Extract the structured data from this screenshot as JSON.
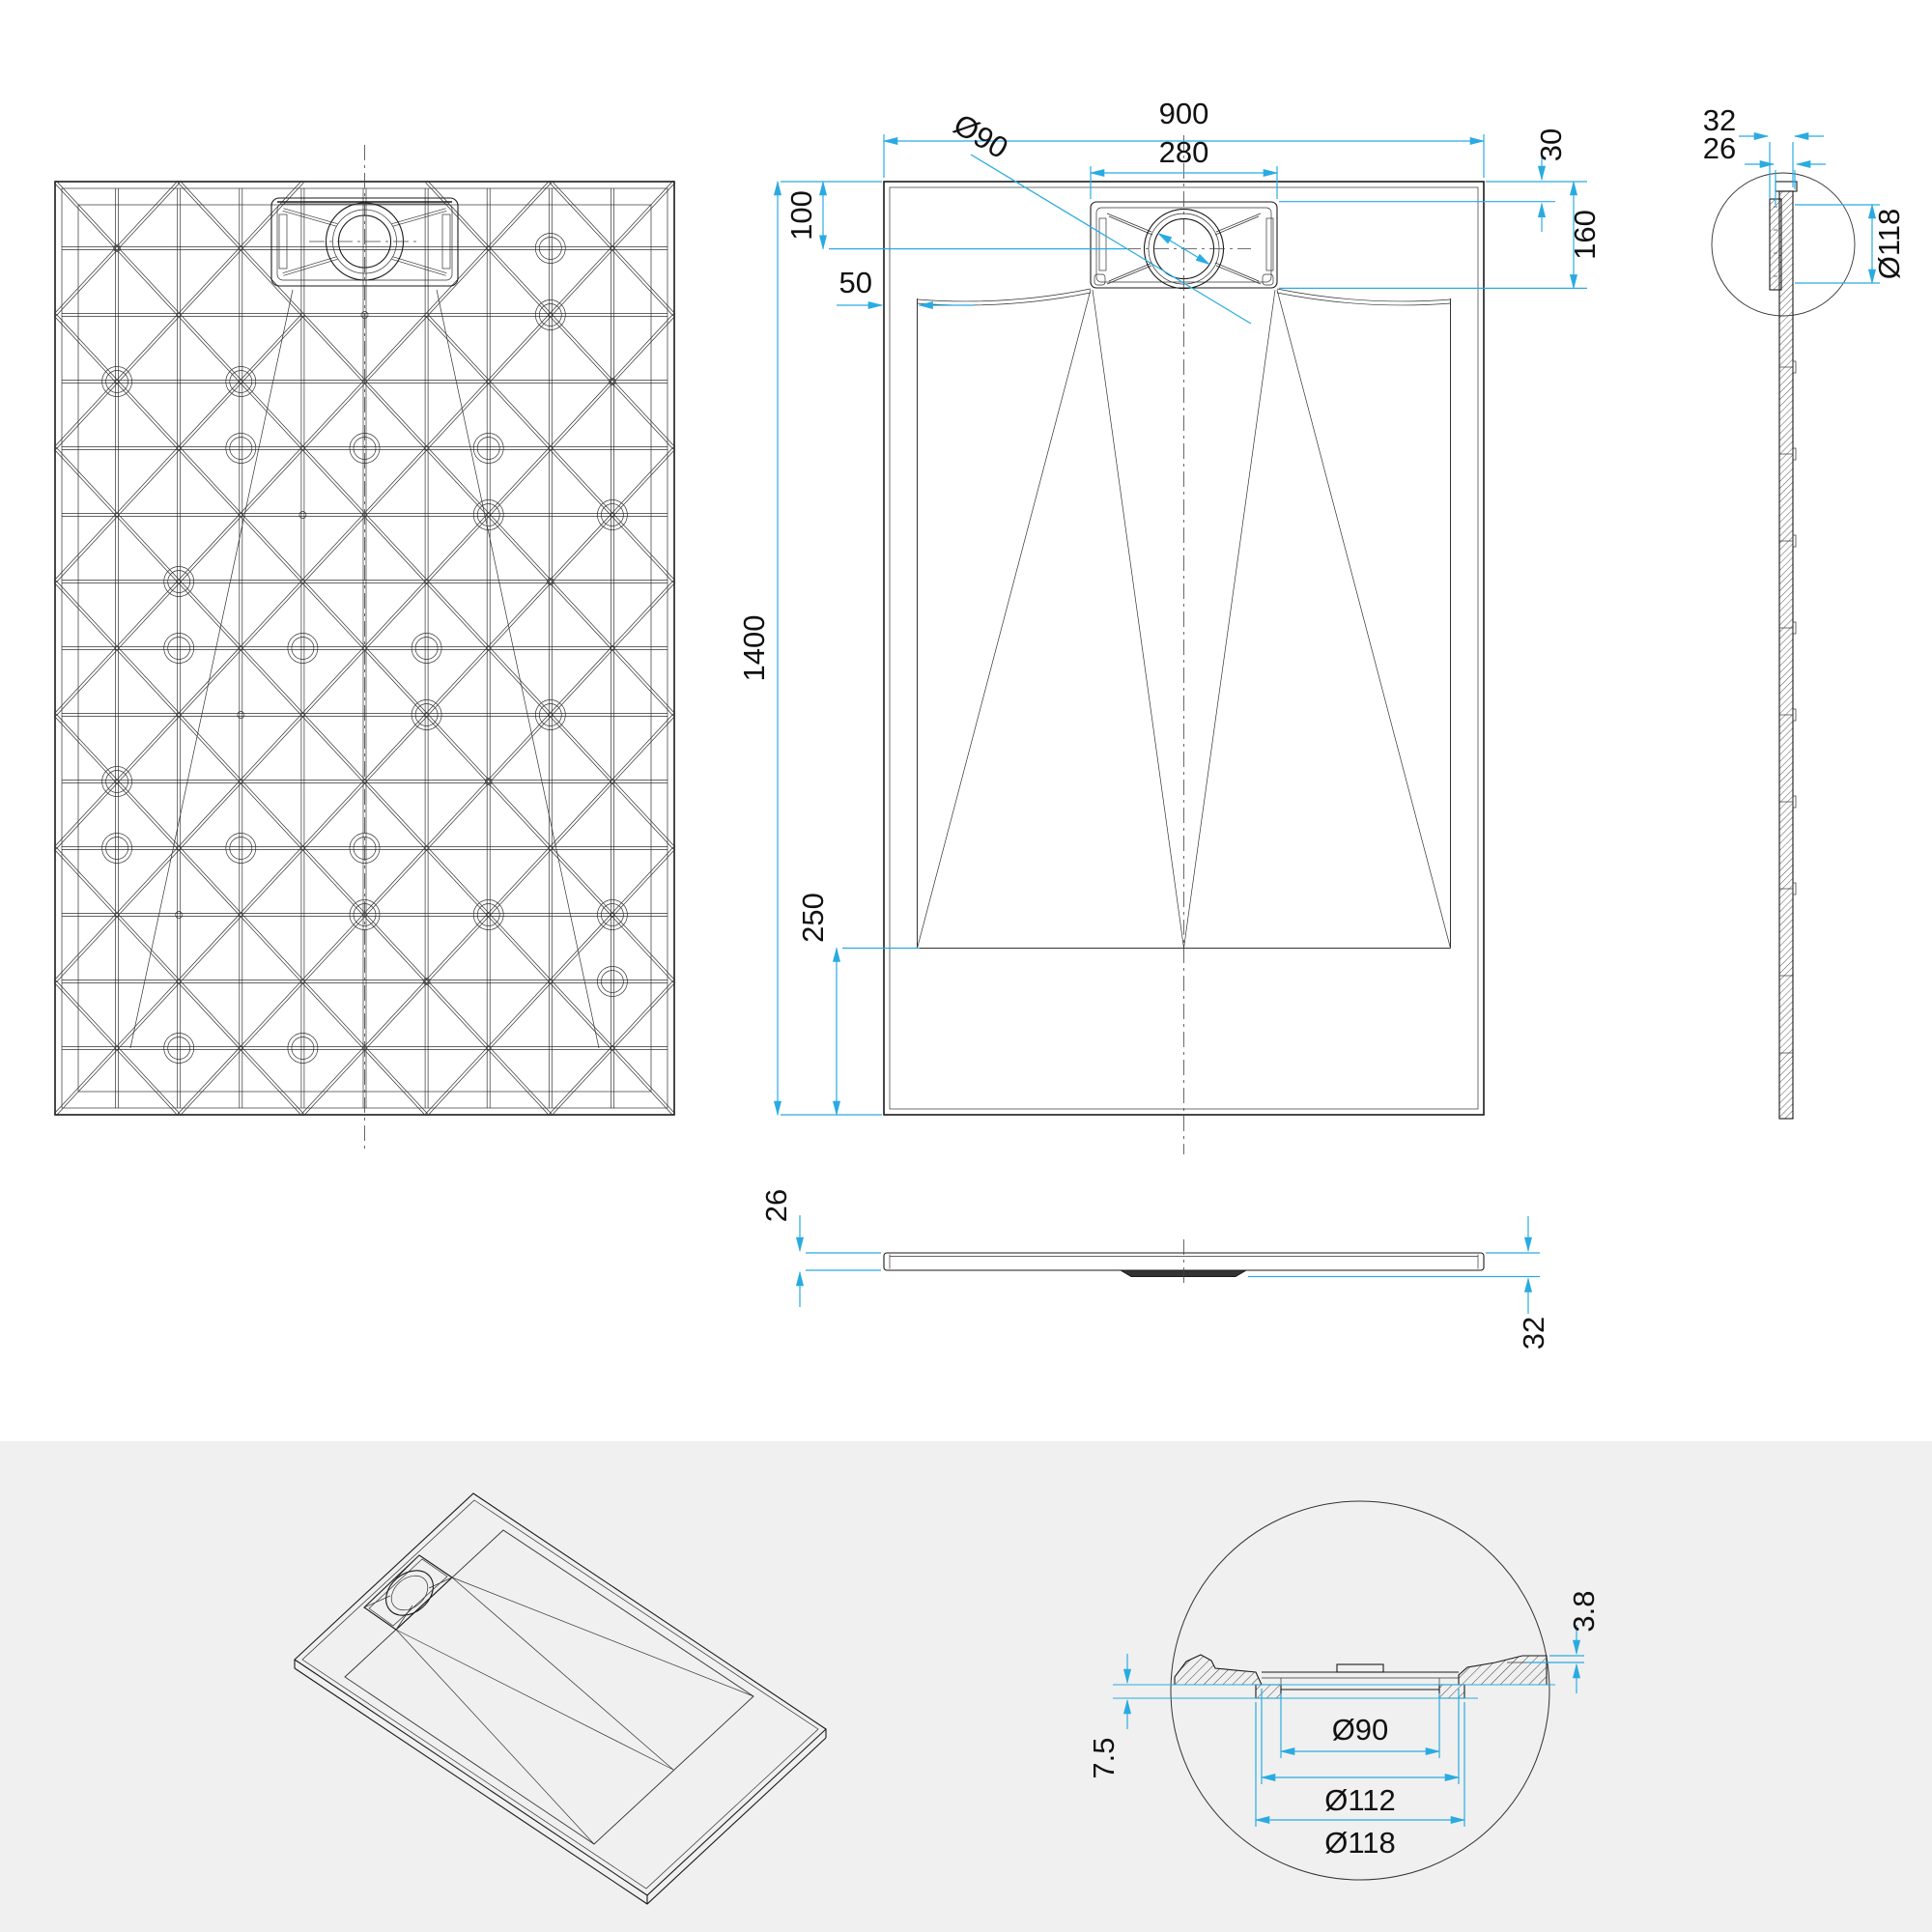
{
  "colors": {
    "dimension": "#29ABE2",
    "line": "#1a1a1a",
    "background_top": "#ffffff",
    "background_bottom": "#f0f0f0"
  },
  "views": {
    "top": {
      "dims": {
        "width": "900",
        "drain_box_width": "280",
        "drain_diameter": "Ø90",
        "drain_center_from_top": "100",
        "side_border": "50",
        "rim_to_drain_box": "30",
        "drain_zone_depth": "160",
        "length": "1400",
        "lower_flat_zone": "250"
      }
    },
    "side": {
      "dims": {
        "total_depth": "32",
        "plate_depth": "26",
        "housing_diameter": "Ø118"
      }
    },
    "front": {
      "dims": {
        "plate_thickness": "26",
        "total_thickness": "32"
      }
    },
    "detail": {
      "dims": {
        "cover_step": "3.8",
        "flange_height": "7.5",
        "drain_hole": "Ø90",
        "flange_inner": "Ø112",
        "flange_outer": "Ø118"
      }
    }
  }
}
